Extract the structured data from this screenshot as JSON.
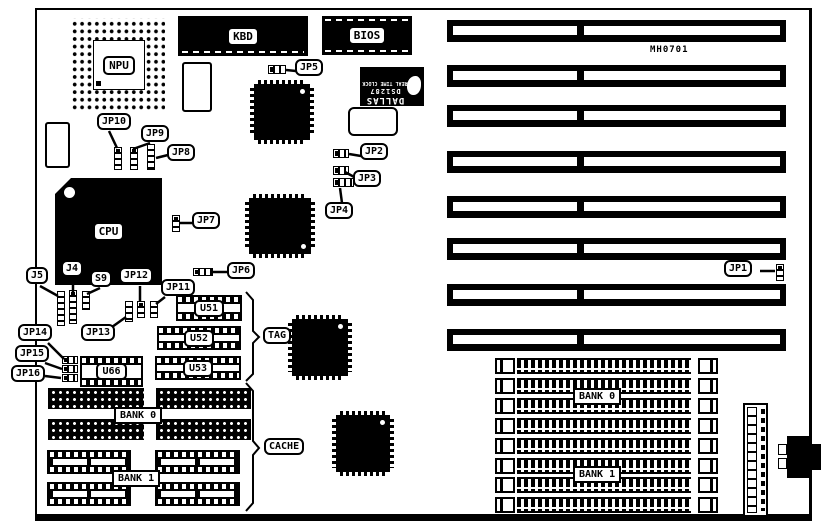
{
  "board_id": "MH0701",
  "chips": {
    "npu": "NPU",
    "cpu": "CPU",
    "kbd": "KBD",
    "bios": "BIOS"
  },
  "dallas": {
    "brand": "DALLAS",
    "part": "DS1287",
    "desc": "REAL TIME CLOCK"
  },
  "jumper_labels": {
    "jp1": "JP1",
    "jp2": "JP2",
    "jp3": "JP3",
    "jp4": "JP4",
    "jp5": "JP5",
    "jp6": "JP6",
    "jp7": "JP7",
    "jp8": "JP8",
    "jp9": "JP9",
    "jp10": "JP10",
    "jp11": "JP11",
    "jp12": "JP12",
    "jp13": "JP13",
    "jp14": "JP14",
    "jp15": "JP15",
    "jp16": "JP16",
    "j4": "J4",
    "j5": "J5",
    "s9": "S9"
  },
  "cache_sockets": {
    "u51": "U51",
    "u52": "U52",
    "u53": "U53",
    "u66": "U66"
  },
  "memory": {
    "dram_bank0": "BANK 0",
    "dram_bank1": "BANK 1",
    "simm_bank0": "BANK 0",
    "simm_bank1": "BANK 1"
  },
  "groups": {
    "tag": "TAG",
    "cache": "CACHE"
  },
  "colors": {
    "ink": "#000000",
    "background": "#ffffff"
  }
}
